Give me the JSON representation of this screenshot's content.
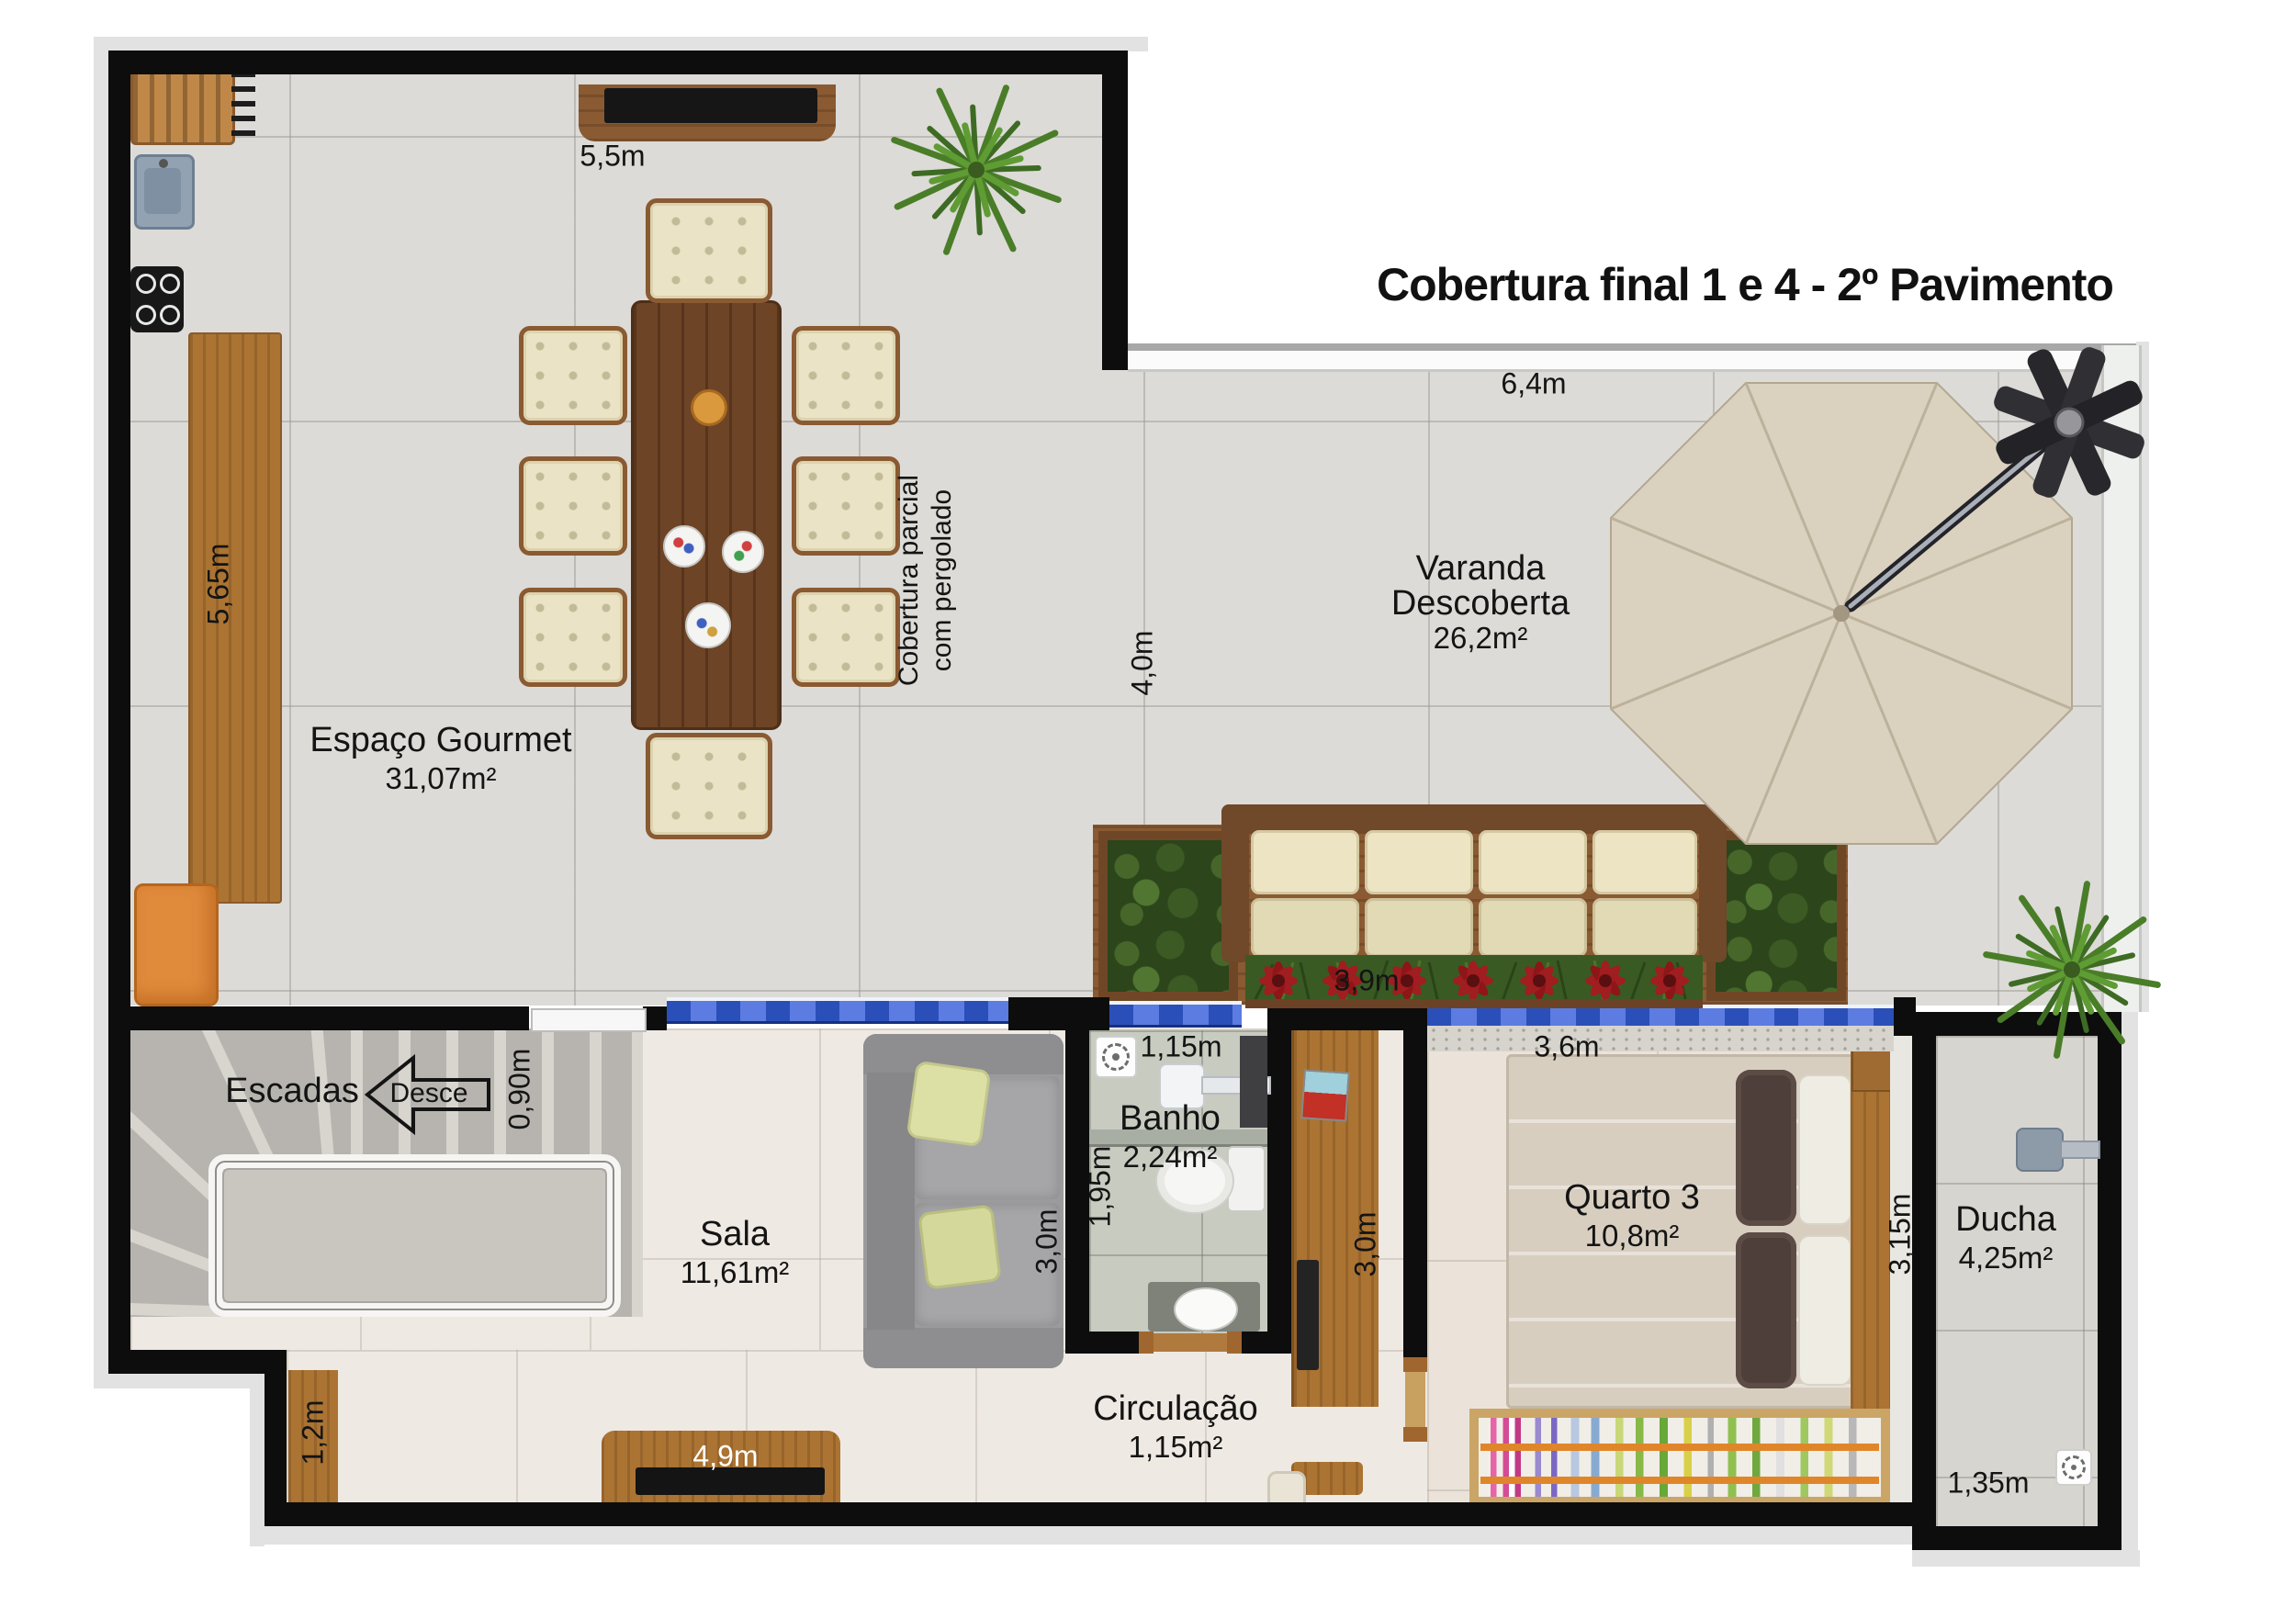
{
  "title": "Cobertura final 1 e 4 - 2º Pavimento",
  "rooms": {
    "gourmet": {
      "name": "Espaço Gourmet",
      "area": "31,07m²"
    },
    "varanda": {
      "line1": "Varanda",
      "line2": "Descoberta",
      "area": "26,2m²"
    },
    "sala": {
      "name": "Sala",
      "area": "11,61m²"
    },
    "banho": {
      "name": "Banho",
      "area": "2,24m²"
    },
    "quarto": {
      "name": "Quarto 3",
      "area": "10,8m²"
    },
    "ducha": {
      "name": "Ducha",
      "area": "4,25m²"
    },
    "circulacao": {
      "name": "Circulação",
      "area": "1,15m²"
    },
    "escadas": {
      "name": "Escadas",
      "arrow": "Desce"
    }
  },
  "notes": {
    "pergola_line1": "Cobertura parcial",
    "pergola_line2": "com pergolado"
  },
  "dims": {
    "gourmet_top": "5,5m",
    "kitchen_counter": "5,65m",
    "varanda_top": "6,4m",
    "varanda_height": "4,0m",
    "varanda_sofa": "3,9m",
    "stairs_door": "0,90m",
    "banho_width": "1,15m",
    "banho_height": "1,95m",
    "sala_height": "3,0m",
    "circ_height": "3,0m",
    "quarto_width": "3,6m",
    "ducha_height": "3,15m",
    "sala_tv": "4,9m",
    "sala_step": "1,2m",
    "ducha_width": "1,35m"
  },
  "colors": {
    "wall": "#0d0d0d",
    "floor_tile": "#dcdbd7",
    "floor_interior": "#efe9e3",
    "wood": "#ab7433",
    "glass_blue": "#3f66cc",
    "garden_green": "#3a5a23",
    "flower_red": "#a51e22",
    "umbrella": "#dad1bf",
    "cushion_cream": "#ece4c2",
    "cabinet_orange": "#e08a3c"
  }
}
